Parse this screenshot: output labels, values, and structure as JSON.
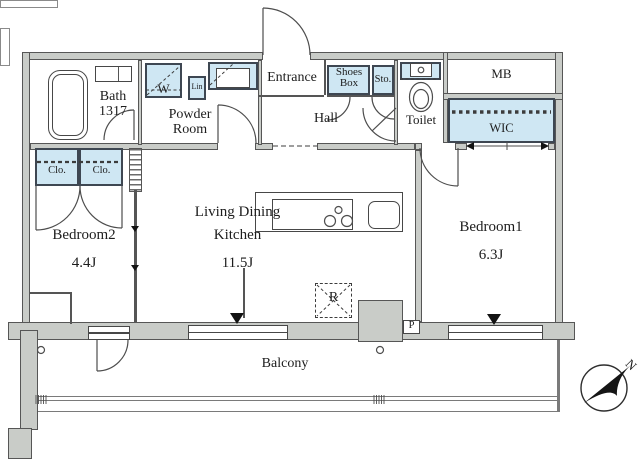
{
  "rooms": {
    "bath": {
      "name": "Bath",
      "size": "1317"
    },
    "powder_room": {
      "line1": "Powder",
      "line2": "Room"
    },
    "entrance": {
      "name": "Entrance"
    },
    "hall": {
      "name": "Hall"
    },
    "toilet": {
      "name": "Toilet"
    },
    "bedroom2": {
      "name": "Bedroom2",
      "area": "4.4J"
    },
    "living_dining_kitchen": {
      "line1": "Living Dining",
      "line2": "Kitchen",
      "area": "11.5J"
    },
    "bedroom1": {
      "name": "Bedroom1",
      "area": "6.3J"
    },
    "balcony": {
      "name": "Balcony"
    },
    "wic": {
      "name": "WIC"
    }
  },
  "fixtures": {
    "washer": "W",
    "linen": "Lin",
    "shoes_box": {
      "line1": "Shoes",
      "line2": "Box"
    },
    "storage": "Sto.",
    "meter_box": "MB",
    "closet_left": "Clo.",
    "closet_right": "Clo.",
    "refrigerator": "R",
    "pipe_space": "P"
  },
  "compass": {
    "north": "N"
  },
  "colors": {
    "fixture_fill": "#cfe7f3",
    "wall_fill": "#c9ccc8",
    "line": "#4d4d4d"
  }
}
